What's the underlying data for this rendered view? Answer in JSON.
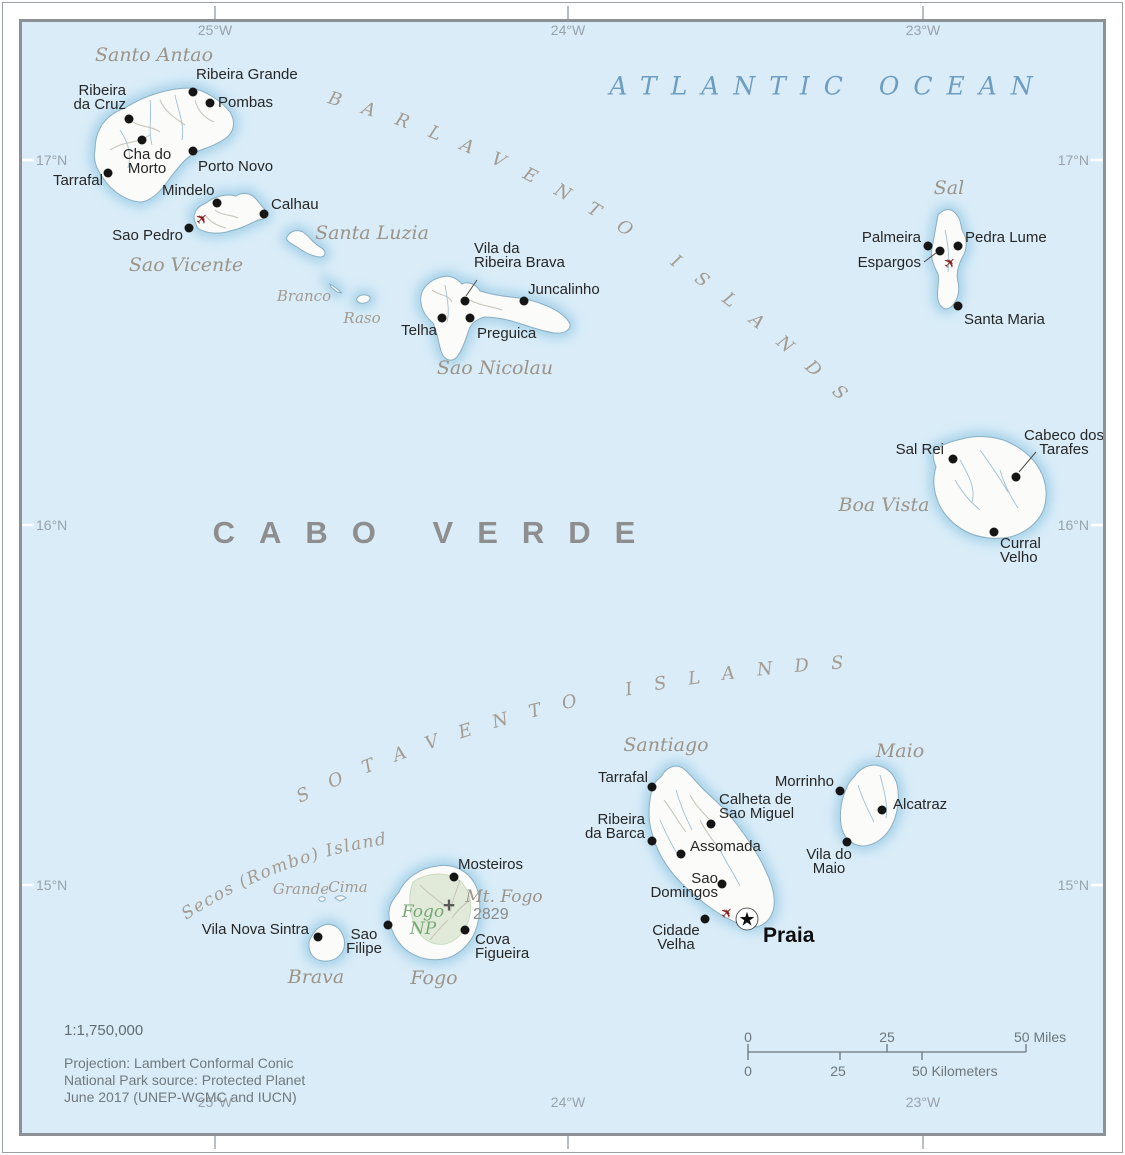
{
  "country_label": "CABO VERDE",
  "sea": {
    "atlantic": "ATLANTIC OCEAN",
    "barlavento": "BARLAVENTO ISLANDS",
    "sotavento": "SOTAVENTO ISLANDS",
    "secos": "Secos (Rombo) Islands"
  },
  "graticule": {
    "lons": [
      "25°W",
      "24°W",
      "23°W"
    ],
    "lats": [
      "17°N",
      "16°N",
      "15°N"
    ]
  },
  "credits": {
    "scale_text": "1:1,750,000",
    "projection": "Projection: Lambert Conformal Conic",
    "np_source": "National Park source: Protected Planet",
    "date_line": "June 2017 (UNEP-WCMC and IUCN)"
  },
  "scalebar": {
    "miles": [
      "0",
      "25",
      "50 Miles"
    ],
    "km": [
      "0",
      "25",
      "50 Kilometers"
    ]
  },
  "colors": {
    "ocean": "#d9ecf8",
    "island_halo": "#a9d3e9",
    "island_fill": "#fbfbf9",
    "coastline": "#8aafc4",
    "airport_red": "#8b2222",
    "park_green": "#76a876",
    "label_gray": "#9c9489"
  },
  "island_labels": [
    {
      "text": "Santo Antao",
      "pos": [
        154,
        55
      ],
      "size": "big"
    },
    {
      "text": "Sao Vicente",
      "pos": [
        186,
        265
      ],
      "size": "big"
    },
    {
      "text": "Santa Luzia",
      "pos": [
        372,
        233
      ],
      "size": "big"
    },
    {
      "text": "Branco",
      "pos": [
        304,
        296
      ],
      "size": "small"
    },
    {
      "text": "Raso",
      "pos": [
        362,
        318
      ],
      "size": "small"
    },
    {
      "text": "Sao Nicolau",
      "pos": [
        495,
        368
      ],
      "size": "big"
    },
    {
      "text": "Sal",
      "pos": [
        949,
        188
      ],
      "size": "big"
    },
    {
      "text": "Boa Vista",
      "pos": [
        884,
        505
      ],
      "size": "big"
    },
    {
      "text": "Santiago",
      "pos": [
        666,
        745
      ],
      "size": "big"
    },
    {
      "text": "Maio",
      "pos": [
        900,
        751
      ],
      "size": "big"
    },
    {
      "text": "Grande",
      "pos": [
        301,
        889
      ],
      "size": "small"
    },
    {
      "text": "Cima",
      "pos": [
        348,
        887
      ],
      "size": "small"
    },
    {
      "text": "Brava",
      "pos": [
        316,
        977
      ],
      "size": "big"
    },
    {
      "text": "Fogo",
      "pos": [
        434,
        978
      ],
      "size": "big"
    }
  ],
  "cities": [
    {
      "lines": [
        "Ribeira Grande"
      ],
      "dot": [
        193,
        92
      ],
      "label": [
        196,
        68
      ],
      "align": "start"
    },
    {
      "lines": [
        "Pombas"
      ],
      "dot": [
        210,
        103
      ],
      "label": [
        218,
        96
      ],
      "align": "start"
    },
    {
      "lines": [
        "Ribeira",
        "da Cruz"
      ],
      "dot": [
        129,
        119
      ],
      "label": [
        126,
        84
      ],
      "align": "end"
    },
    {
      "lines": [
        "Cha do",
        "Morto"
      ],
      "dot": [
        142,
        140
      ],
      "label": [
        147,
        148
      ],
      "align": "middle"
    },
    {
      "lines": [
        "Porto Novo"
      ],
      "dot": [
        193,
        151
      ],
      "label": [
        198,
        160
      ],
      "align": "start"
    },
    {
      "lines": [
        "Tarrafal"
      ],
      "dot": [
        108,
        173
      ],
      "label": [
        103,
        174
      ],
      "align": "end"
    },
    {
      "lines": [
        "Mindelo"
      ],
      "dot": [
        217,
        203
      ],
      "label": [
        162,
        184
      ],
      "align": "start"
    },
    {
      "lines": [
        "Calhau"
      ],
      "dot": [
        264,
        214
      ],
      "label": [
        271,
        198
      ],
      "align": "start"
    },
    {
      "lines": [
        "Sao Pedro"
      ],
      "dot": [
        189,
        228
      ],
      "label": [
        183,
        229
      ],
      "align": "end"
    },
    {
      "lines": [
        "Vila da",
        "Ribeira Brava"
      ],
      "dot": [
        465,
        301
      ],
      "label": [
        474,
        242
      ],
      "align": "start",
      "leader": [
        [
          477,
          280
        ],
        [
          466,
          296
        ]
      ]
    },
    {
      "lines": [
        "Juncalinho"
      ],
      "dot": [
        524,
        301
      ],
      "label": [
        528,
        283
      ],
      "align": "start"
    },
    {
      "lines": [
        "Telha"
      ],
      "dot": [
        442,
        318
      ],
      "label": [
        437,
        324
      ],
      "align": "end"
    },
    {
      "lines": [
        "Preguica"
      ],
      "dot": [
        470,
        318
      ],
      "label": [
        477,
        327
      ],
      "align": "start"
    },
    {
      "lines": [
        "Palmeira"
      ],
      "dot": [
        928,
        246
      ],
      "label": [
        921,
        231
      ],
      "align": "end"
    },
    {
      "lines": [
        "Pedra Lume"
      ],
      "dot": [
        958,
        246
      ],
      "label": [
        965,
        231
      ],
      "align": "start"
    },
    {
      "lines": [
        "Espargos"
      ],
      "dot": [
        940,
        251
      ],
      "label": [
        921,
        256
      ],
      "align": "end",
      "leader": [
        [
          924,
          262
        ],
        [
          936,
          253
        ]
      ]
    },
    {
      "lines": [
        "Santa Maria"
      ],
      "dot": [
        958,
        306
      ],
      "label": [
        964,
        313
      ],
      "align": "start"
    },
    {
      "lines": [
        "Sal Rei"
      ],
      "dot": [
        953,
        459
      ],
      "label": [
        944,
        443
      ],
      "align": "end"
    },
    {
      "lines": [
        "Cabeco dos",
        "Tarafes"
      ],
      "dot": [
        1016,
        477
      ],
      "label": [
        1064,
        429
      ],
      "align": "middle",
      "leader": [
        [
          1019,
          472
        ],
        [
          1036,
          452
        ]
      ]
    },
    {
      "lines": [
        "Curral",
        "Velho"
      ],
      "dot": [
        994,
        532
      ],
      "label": [
        1000,
        537
      ],
      "align": "start"
    },
    {
      "lines": [
        "Tarrafal"
      ],
      "dot": [
        652,
        787
      ],
      "label": [
        648,
        771
      ],
      "align": "end"
    },
    {
      "lines": [
        "Calheta de",
        "Sao Miguel"
      ],
      "dot": [
        711,
        824
      ],
      "label": [
        719,
        793
      ],
      "align": "start"
    },
    {
      "lines": [
        "Ribeira",
        "da Barca"
      ],
      "dot": [
        652,
        841
      ],
      "label": [
        645,
        813
      ],
      "align": "end"
    },
    {
      "lines": [
        "Assomada"
      ],
      "dot": [
        681,
        854
      ],
      "label": [
        690,
        840
      ],
      "align": "start"
    },
    {
      "lines": [
        "Sao",
        "Domingos"
      ],
      "dot": [
        722,
        884
      ],
      "label": [
        718,
        872
      ],
      "align": "end"
    },
    {
      "lines": [
        "Cidade",
        "Velha"
      ],
      "dot": [
        705,
        919
      ],
      "label": [
        676,
        924
      ],
      "align": "middle"
    },
    {
      "lines": [
        "Praia"
      ],
      "dot": [
        747,
        919
      ],
      "label": [
        763,
        926
      ],
      "align": "start",
      "capital": true
    },
    {
      "lines": [
        "Morrinho"
      ],
      "dot": [
        840,
        791
      ],
      "label": [
        834,
        775
      ],
      "align": "end"
    },
    {
      "lines": [
        "Alcatraz"
      ],
      "dot": [
        882,
        810
      ],
      "label": [
        893,
        798
      ],
      "align": "start"
    },
    {
      "lines": [
        "Vila do",
        "Maio"
      ],
      "dot": [
        847,
        842
      ],
      "label": [
        829,
        848
      ],
      "align": "middle"
    },
    {
      "lines": [
        "Vila Nova Sintra"
      ],
      "dot": [
        318,
        937
      ],
      "label": [
        309,
        923
      ],
      "align": "end"
    },
    {
      "lines": [
        "Sao",
        "Filipe"
      ],
      "dot": [
        388,
        925
      ],
      "label": [
        364,
        928
      ],
      "align": "middle"
    },
    {
      "lines": [
        "Mosteiros"
      ],
      "dot": [
        454,
        877
      ],
      "label": [
        458,
        858
      ],
      "align": "start"
    },
    {
      "lines": [
        "Cova",
        "Figueira"
      ],
      "dot": [
        465,
        930
      ],
      "label": [
        475,
        933
      ],
      "align": "start"
    }
  ],
  "airports": [
    [
      202,
      219
    ],
    [
      950,
      263
    ],
    [
      727,
      913
    ]
  ],
  "peak": {
    "symbol": "+",
    "pos": [
      449,
      906
    ],
    "name": "Mt. Fogo",
    "name_pos": [
      504,
      897
    ],
    "elev": "2829",
    "elev_pos": [
      473,
      906
    ]
  },
  "park": {
    "lines": [
      "Fogo",
      "NP"
    ],
    "pos": [
      423,
      921
    ]
  }
}
